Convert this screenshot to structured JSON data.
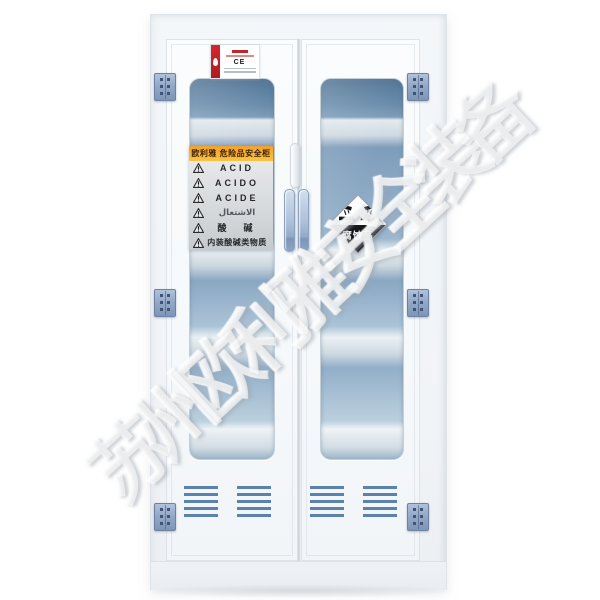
{
  "product": {
    "watermark_text": "苏州欧利雅安全装备",
    "certificate_label": {
      "ce_text": "CE"
    },
    "warning_label": {
      "header": "欧利雅 危险品安全柜",
      "rows": [
        {
          "icon": "warning-triangle-icon",
          "text": "ACID"
        },
        {
          "icon": "warning-triangle-icon",
          "text": "ACIDO"
        },
        {
          "icon": "warning-triangle-icon",
          "text": "ACIDE"
        },
        {
          "icon": "warning-triangle-icon",
          "text": "الاشتعال"
        },
        {
          "icon": "warning-triangle-icon",
          "text": "酸　碱"
        },
        {
          "icon": "warning-triangle-icon",
          "text": "内装酸碱类物质"
        }
      ]
    },
    "hazard_diamond": {
      "class": "corrosive",
      "text": "腐蚀品"
    },
    "colors": {
      "glass_blue": "#6f94b6",
      "hinge_blue": "#8ba2c6",
      "vent_blue": "#5b82ad",
      "label_yellow": "#f8b133",
      "stripe_red": "#cd2228",
      "diamond_black": "#15151a"
    }
  }
}
